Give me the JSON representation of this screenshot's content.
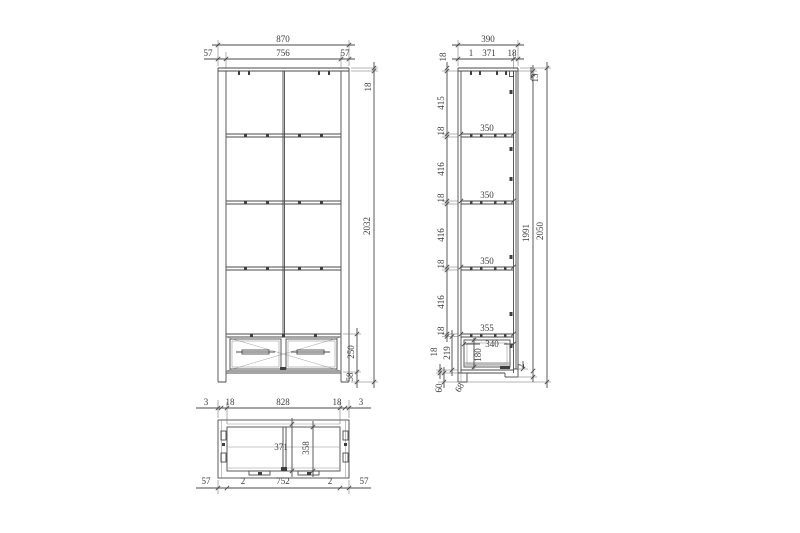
{
  "meta": {
    "title": "wardrobe-technical-drawing",
    "colors": {
      "line-color": "#4a4a4a",
      "text-color": "#3a3a3a",
      "background": "#ffffff"
    }
  },
  "views": {
    "front": {
      "w_total": "870",
      "w_l": "57",
      "w_c": "756",
      "w_r": "57",
      "top_t": "18",
      "h_body": "2032",
      "drawer_h": "250",
      "base_h": "58"
    },
    "side": {
      "d_total": "390",
      "d_gap": "1",
      "d_inner": "371",
      "d_front": "18",
      "top_t": "18",
      "back_inset": "13",
      "col": [
        "415",
        "18",
        "416",
        "18",
        "416",
        "18",
        "416",
        "18"
      ],
      "shelves": [
        "350",
        "350",
        "350"
      ],
      "rail": "355",
      "drawer_d": "340",
      "drawer_ih": "180",
      "bottom_inner": "219",
      "bottom_t": "18",
      "plinth_h": "60",
      "leg_d": "68",
      "gap2": "2",
      "h_inner": "1991",
      "h_total": "2050"
    },
    "bottom": {
      "top": [
        "3",
        "18",
        "828",
        "18",
        "3"
      ],
      "bot": [
        "57",
        "2",
        "752",
        "2",
        "57"
      ],
      "inner_a": "371",
      "inner_b": "358"
    }
  }
}
